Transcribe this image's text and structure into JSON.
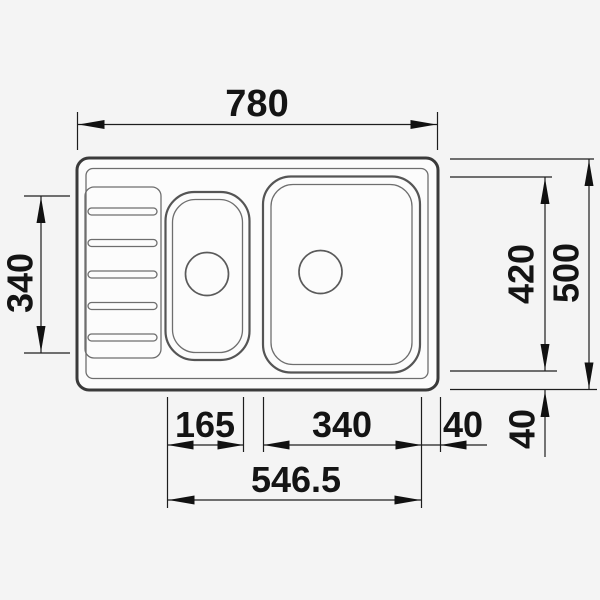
{
  "page": {
    "background": "#f4f4f4"
  },
  "drawing": {
    "subject": "kitchen-sink-top-view-technical-drawing",
    "dim": {
      "top_width": "780",
      "left_length": "340",
      "right_inner_depth": "420",
      "right_overall_depth": "500",
      "small_bowl_width": "165",
      "main_bowl_width": "340",
      "right_margin": "40",
      "bottom_margin": "40",
      "bowls_span": "546.5"
    },
    "colors": {
      "line": "#1d1d1d",
      "outline": "#3a3a3a",
      "background": "#f4f4f4"
    }
  }
}
